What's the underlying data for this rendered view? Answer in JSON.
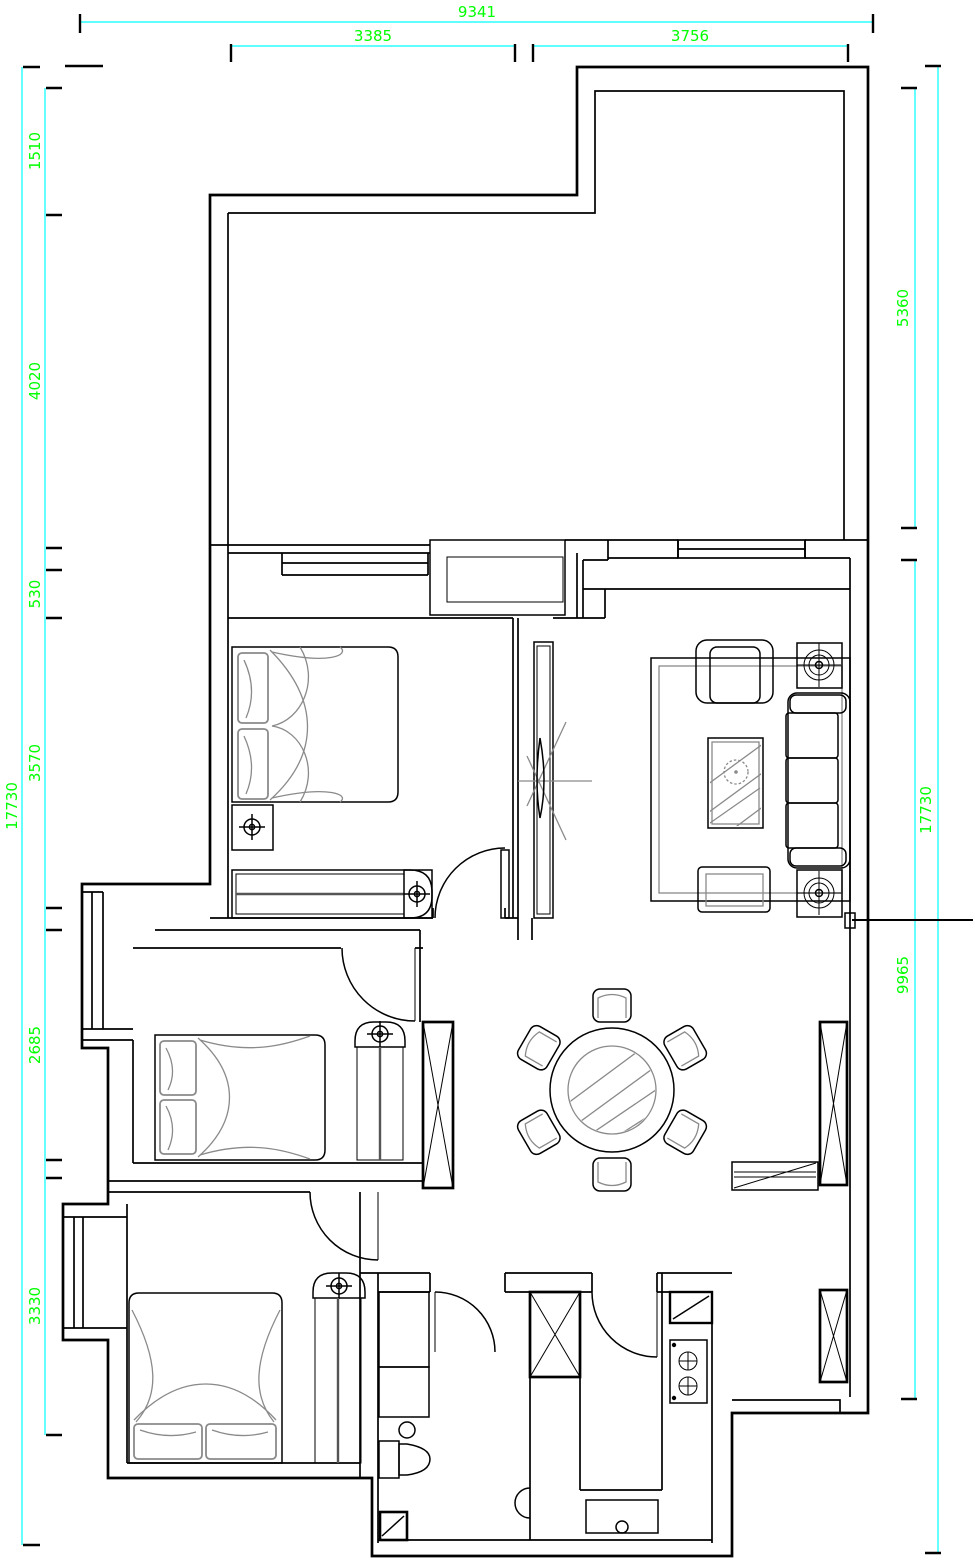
{
  "meta": {
    "drawing_type": "apartment floor plan (CAD)",
    "units": "mm"
  },
  "colors": {
    "background": "#ffffff",
    "wall": "#000000",
    "dim_line": "#00ffff",
    "dim_text": "#00ff00",
    "furniture": "#8a8a8a"
  },
  "dimensions": {
    "top_total": "9341",
    "top_left": "3385",
    "top_right": "3756",
    "left_total": "17730",
    "left_seg1": "1510",
    "left_seg2": "4020",
    "left_seg3": "530",
    "left_seg4": "3570",
    "left_seg5": "2685",
    "left_seg6": "3330",
    "right_seg1": "5360",
    "right_seg2": "9965",
    "right_total": "17730"
  }
}
